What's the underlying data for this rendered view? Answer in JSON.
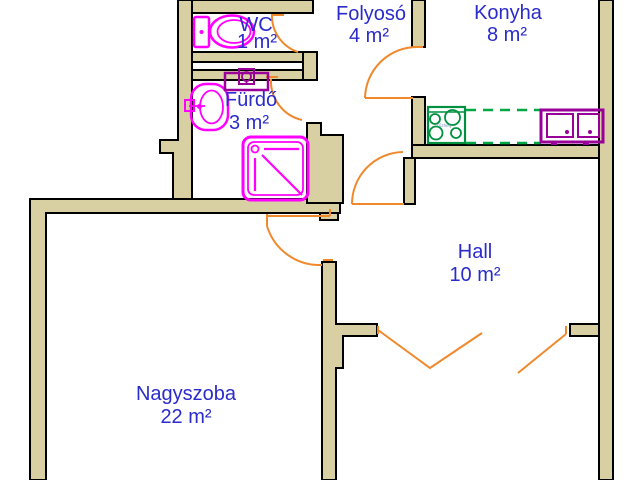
{
  "floorplan": {
    "rooms": [
      {
        "name": "WC",
        "area": "1 m²"
      },
      {
        "name": "Fürdő",
        "area": "3 m²"
      },
      {
        "name": "Folyosó",
        "area": "4 m²"
      },
      {
        "name": "Konyha",
        "area": "8 m²"
      },
      {
        "name": "Hall",
        "area": "10 m²"
      },
      {
        "name": "Nagyszoba",
        "area": "22 m²"
      }
    ],
    "fixtures": {
      "stove_label": "Tűzhely",
      "items": [
        "toilet",
        "washbasin",
        "bathroom-shelf",
        "shower",
        "stove",
        "kitchen-sink",
        "kitchen-counter"
      ]
    },
    "colors": {
      "wall_fill": "#D8CFA2",
      "wall_outline": "#000000",
      "door": "#F0882C",
      "fixture_magenta": "#FF00FF",
      "fixture_purple": "#990099",
      "stove_green": "#009140",
      "counter_green": "#00A843",
      "label_blue": "#2B2BCB",
      "background": "#FFFFFF"
    }
  }
}
